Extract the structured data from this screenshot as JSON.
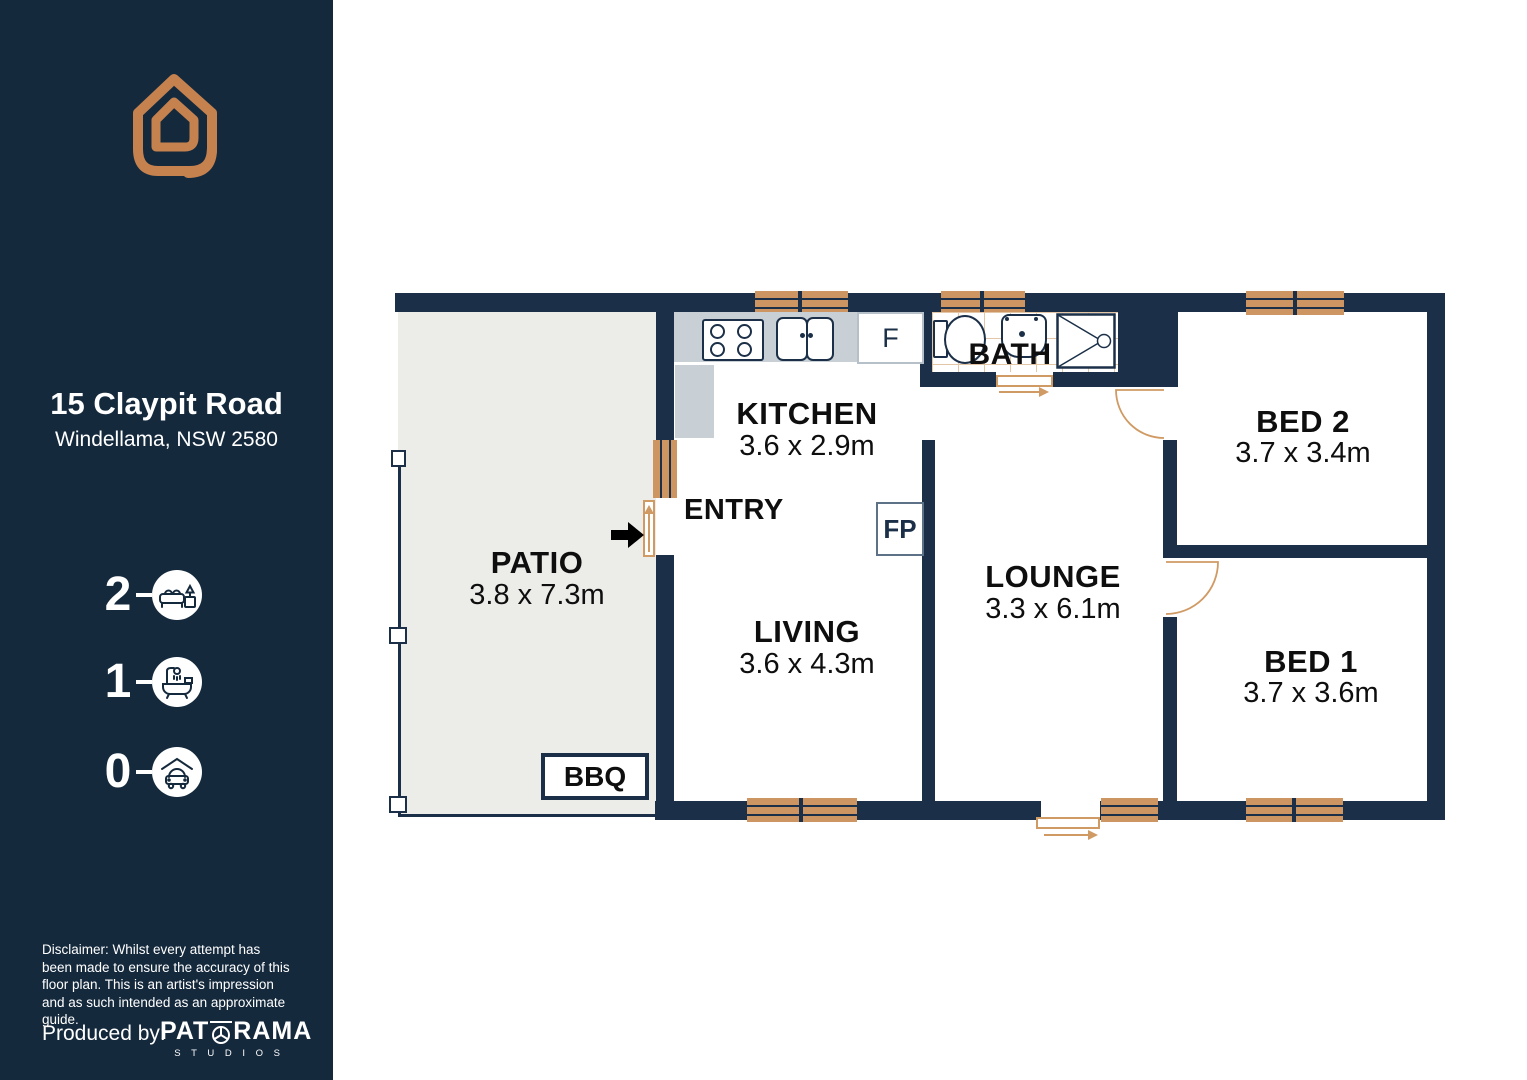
{
  "sidebar": {
    "address_line1": "15 Claypit Road",
    "address_line2": "Windellama, NSW 2580",
    "stats": {
      "beds": {
        "count": "2",
        "icon": "bed-icon"
      },
      "baths": {
        "count": "1",
        "icon": "bath-icon"
      },
      "cars": {
        "count": "0",
        "icon": "car-icon"
      }
    },
    "disclaimer": "Disclaimer: Whilst every attempt has been made to ensure the accuracy of this floor plan. This is an artist's impression and as such intended as an approximate guide.",
    "produced_by": "Produced by:",
    "brand_pat": "PAT",
    "brand_rama": "RAMA",
    "brand_studios": "S T U D I O S"
  },
  "floorplan": {
    "rooms": {
      "patio": {
        "name": "PATIO",
        "dims": "3.8 x 7.3m"
      },
      "kitchen": {
        "name": "KITCHEN",
        "dims": "3.6 x 2.9m"
      },
      "entry": {
        "name": "ENTRY"
      },
      "living": {
        "name": "LIVING",
        "dims": "3.6 x 4.3m"
      },
      "bath": {
        "name": "BATH"
      },
      "lounge": {
        "name": "LOUNGE",
        "dims": "3.3 x 6.1m"
      },
      "bed2": {
        "name": "BED 2",
        "dims": "3.7 x 3.4m"
      },
      "bed1": {
        "name": "BED 1",
        "dims": "3.7 x 3.6m"
      }
    },
    "features": {
      "bbq": "BBQ",
      "fridge": "F",
      "fireplace": "FP"
    },
    "colors": {
      "wall": "#1b3048",
      "window": "#cc9562",
      "sidebar": "#15293d",
      "accent": "#c5824f",
      "patio": "#ecede9",
      "counter": "#c8cfd5"
    }
  }
}
